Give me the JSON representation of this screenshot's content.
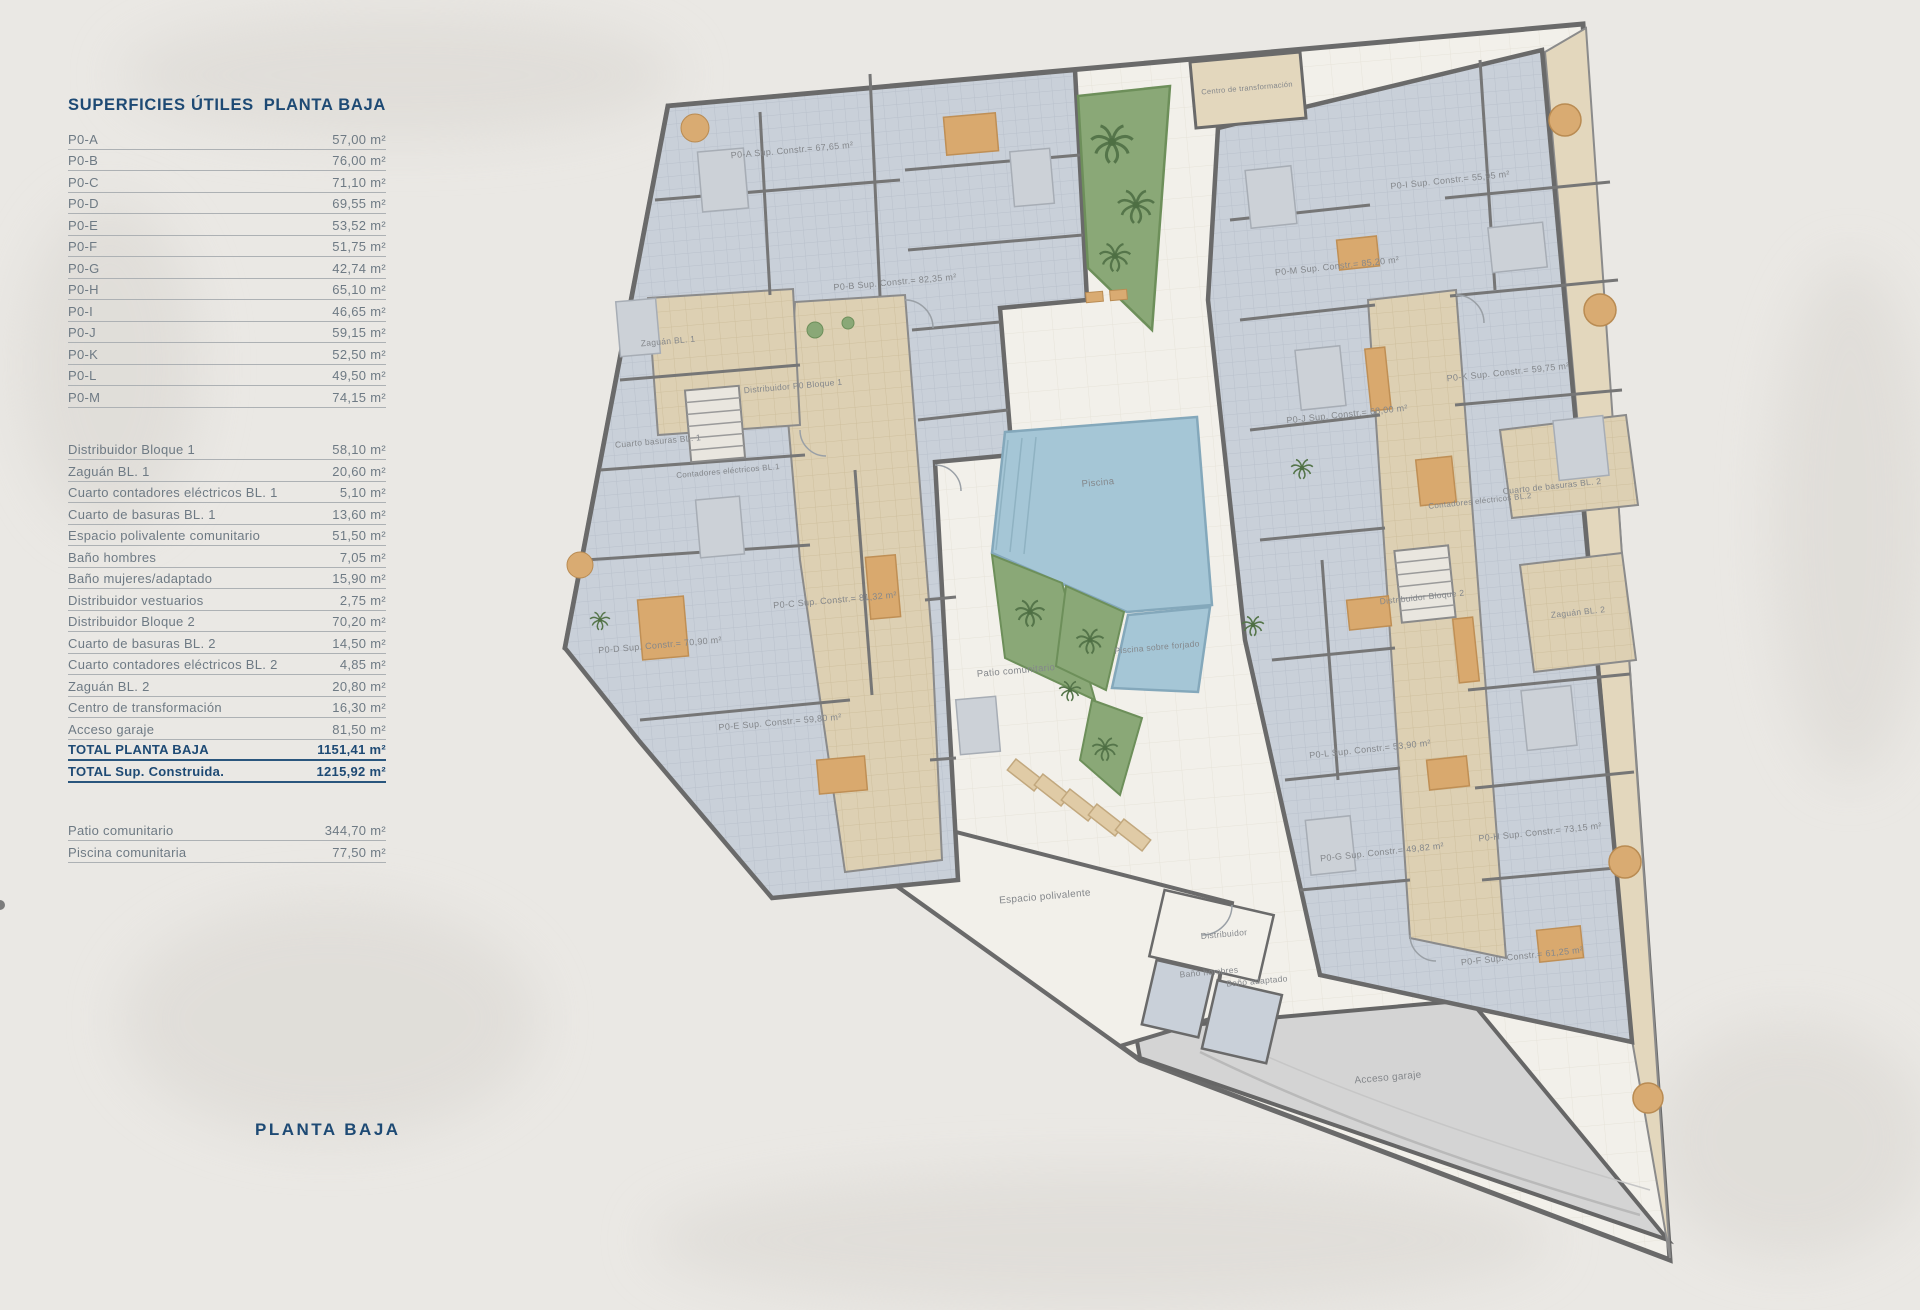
{
  "table": {
    "header_left": "SUPERFICIES ÚTILES",
    "header_right": "PLANTA BAJA",
    "units": [
      {
        "label": "P0-A",
        "value": "57,00 m²"
      },
      {
        "label": "P0-B",
        "value": "76,00 m²"
      },
      {
        "label": "P0-C",
        "value": "71,10 m²"
      },
      {
        "label": "P0-D",
        "value": "69,55 m²"
      },
      {
        "label": "P0-E",
        "value": "53,52 m²"
      },
      {
        "label": "P0-F",
        "value": "51,75 m²"
      },
      {
        "label": "P0-G",
        "value": "42,74 m²"
      },
      {
        "label": "P0-H",
        "value": "65,10 m²"
      },
      {
        "label": "P0-I",
        "value": "46,65 m²"
      },
      {
        "label": "P0-J",
        "value": "59,15 m²"
      },
      {
        "label": "P0-K",
        "value": "52,50 m²"
      },
      {
        "label": "P0-L",
        "value": "49,50 m²"
      },
      {
        "label": "P0-M",
        "value": "74,15 m²"
      }
    ],
    "common": [
      {
        "label": "Distribuidor Bloque 1",
        "value": "58,10 m²"
      },
      {
        "label": "Zaguán BL. 1",
        "value": "20,60 m²"
      },
      {
        "label": "Cuarto contadores eléctricos BL. 1",
        "value": "5,10 m²"
      },
      {
        "label": "Cuarto de basuras BL. 1",
        "value": "13,60 m²"
      },
      {
        "label": "Espacio polivalente comunitario",
        "value": "51,50 m²"
      },
      {
        "label": "Baño hombres",
        "value": "7,05 m²"
      },
      {
        "label": "Baño mujeres/adaptado",
        "value": "15,90 m²"
      },
      {
        "label": "Distribuidor vestuarios",
        "value": "2,75 m²"
      },
      {
        "label": "Distribuidor Bloque 2",
        "value": "70,20 m²"
      },
      {
        "label": "Cuarto de basuras BL. 2",
        "value": "14,50 m²"
      },
      {
        "label": "Cuarto contadores eléctricos BL. 2",
        "value": "4,85 m²"
      },
      {
        "label": "Zaguán BL. 2",
        "value": "20,80 m²"
      },
      {
        "label": "Centro de transformación",
        "value": "16,30 m²"
      },
      {
        "label": "Acceso garaje",
        "value": "81,50 m²"
      }
    ],
    "totals": [
      {
        "label": "TOTAL PLANTA BAJA",
        "value": "1151,41 m²"
      },
      {
        "label": "TOTAL Sup. Construida.",
        "value": "1215,92 m²"
      }
    ],
    "outdoor": [
      {
        "label": "Patio comunitario",
        "value": "344,70 m²"
      },
      {
        "label": "Piscina comunitaria",
        "value": "77,50 m²"
      }
    ]
  },
  "page": {
    "bottom_title": "PLANTA BAJA"
  },
  "plan": {
    "labels": [
      "P0-A Sup. Constr.= 67,65 m²",
      "P0-B Sup. Constr.= 82,35 m²",
      "P0-C Sup. Constr.= 81,32 m²",
      "P0-D Sup. Constr.= 70,90 m²",
      "P0-E Sup. Constr.= 59,80 m²",
      "P0-F Sup. Constr.= 61,25 m²",
      "P0-G Sup. Constr.= 49,82 m²",
      "P0-H Sup. Constr.= 73,15 m²",
      "P0-I Sup. Constr.= 55,95 m²",
      "P0-J Sup. Constr.= 68,00 m²",
      "P0-K Sup. Constr.= 59,75 m²",
      "P0-L Sup. Constr.= 53,90 m²",
      "P0-M Sup. Constr.= 85,20 m²",
      "Zaguán BL. 1",
      "Distribuidor P0 Bloque 1",
      "Cuarto basuras BL. 1",
      "Contadores eléctricos BL.1",
      "Distribuidor Bloque 2",
      "Zaguán BL. 2",
      "Cuarto de basuras BL. 2",
      "Contadores eléctricos BL.2",
      "Centro de transformación",
      "Piscina",
      "Piscina sobre forjado",
      "Patio comunitario",
      "Espacio polivalente",
      "Distribuidor",
      "Baño hombres",
      "Baño adaptado",
      "Acceso garaje"
    ]
  },
  "colors": {
    "navy": "#1e4a74",
    "row_text": "#6e7a84",
    "wall": "#6a6a6a",
    "room_floor": "#c9d0d9",
    "corridor": "#ddd0b3",
    "courtyard": "#f2f0ea",
    "pool": "#a5c6d6",
    "garden": "#8aa877",
    "garage": "#d4d4d4",
    "furniture_tan": "#d9a96e"
  }
}
